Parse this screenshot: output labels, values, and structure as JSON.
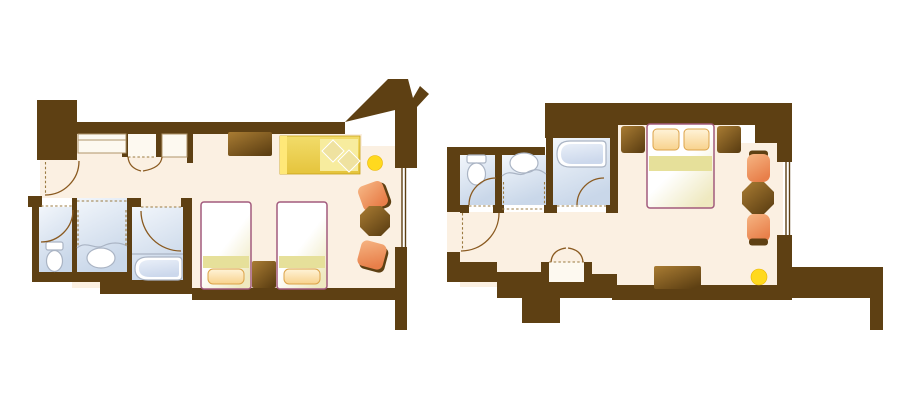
{
  "colors": {
    "background": "#ffffff",
    "wall": "#5e4013",
    "floor": "#fbf0e2",
    "bath_floor_light": "#f2f6fb",
    "bath_floor_dark": "#c9d7e9",
    "fixture_border": "#aab4c4",
    "fixture_fill": "#ffffff",
    "tub_light": "#e9eff8",
    "tub_dark": "#ccd8ec",
    "bed_border": "#a25a7d",
    "bed_light": "#ffffff",
    "bed_dark": "#efe9c0",
    "bed_band": "#e6e09a",
    "pillow_light": "#fff3d8",
    "pillow_dark": "#f8d28c",
    "pillow_border": "#dca349",
    "sofa_light": "#f7ec9e",
    "sofa_mid": "#f2dc6a",
    "sofa_dark": "#e5c43c",
    "sofa_accent": "#ffe878",
    "cushion": "#efe2a0",
    "chair_light": "#f6b583",
    "chair_dark": "#e87f4a",
    "chair_shadow": "#5e4013",
    "wood_light": "#a97c33",
    "wood_dark": "#5e4013",
    "lamp": "#ffd91e",
    "dash": "#9a7a40",
    "arc": "#8a5a20",
    "closet_border": "#b0956a",
    "closet_fill": "#fdf9f0"
  },
  "plans": {
    "left": {
      "id": "twin-room-floor-plan",
      "objects": [
        "entry-door",
        "closet",
        "wardrobe-nook",
        "toilet",
        "washbasin",
        "bathtub",
        "tv-cabinet",
        "sofa",
        "floor-lamp",
        "chair",
        "table",
        "chair",
        "twin-bed",
        "nightstand",
        "twin-bed",
        "window"
      ]
    },
    "right": {
      "id": "double-room-floor-plan",
      "objects": [
        "entry-door",
        "toilet",
        "washbasin",
        "bathtub",
        "wardrobe-nook",
        "nightstand",
        "double-bed",
        "nightstand",
        "chair",
        "table",
        "chair",
        "dresser",
        "floor-lamp",
        "window"
      ]
    }
  }
}
